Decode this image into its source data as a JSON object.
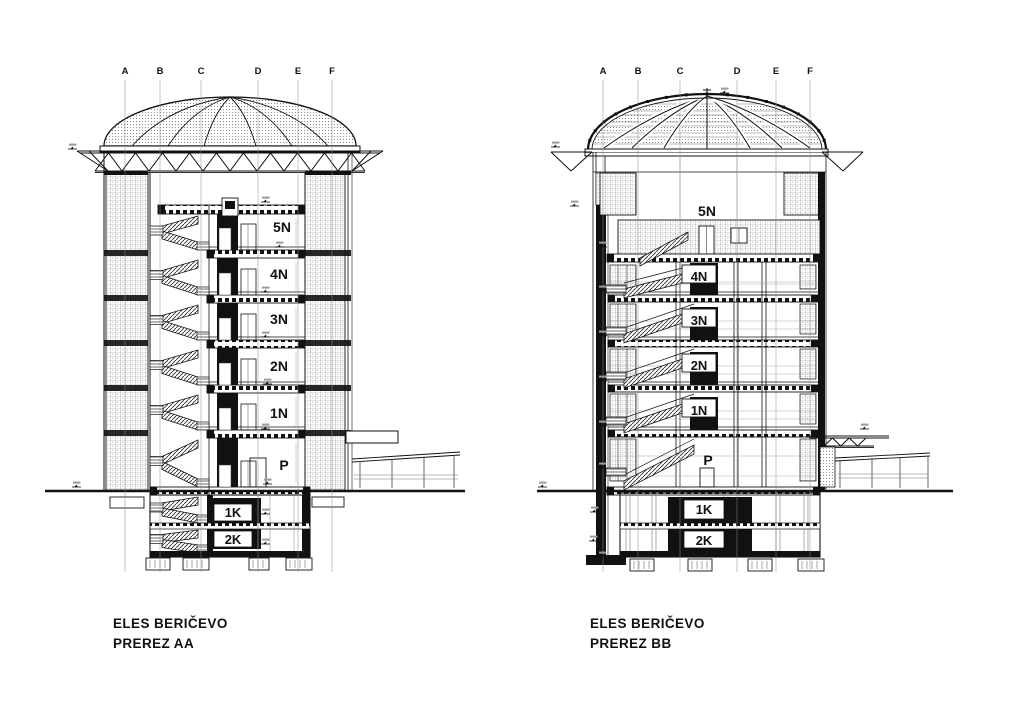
{
  "drawing": {
    "grid_labels": [
      "A",
      "B",
      "C",
      "D",
      "E",
      "F"
    ],
    "section_aa": {
      "title_line1": "ELES BERIČEVO",
      "title_line2": "PREREZ AA",
      "floors": {
        "f5": "5N",
        "f4": "4N",
        "f3": "3N",
        "f2": "2N",
        "f1": "1N",
        "p": "P",
        "k1": "1K",
        "k2": "2K"
      }
    },
    "section_bb": {
      "title_line1": "ELES BERIČEVO",
      "title_line2": "PREREZ BB",
      "floors": {
        "f5": "5N",
        "f4": "4N",
        "f3": "3N",
        "f2": "2N",
        "f1": "1N",
        "p": "P",
        "k1": "1K",
        "k2": "2K"
      }
    },
    "colors": {
      "ink": "#111111",
      "hatch": "#777777",
      "background": "#ffffff"
    }
  }
}
